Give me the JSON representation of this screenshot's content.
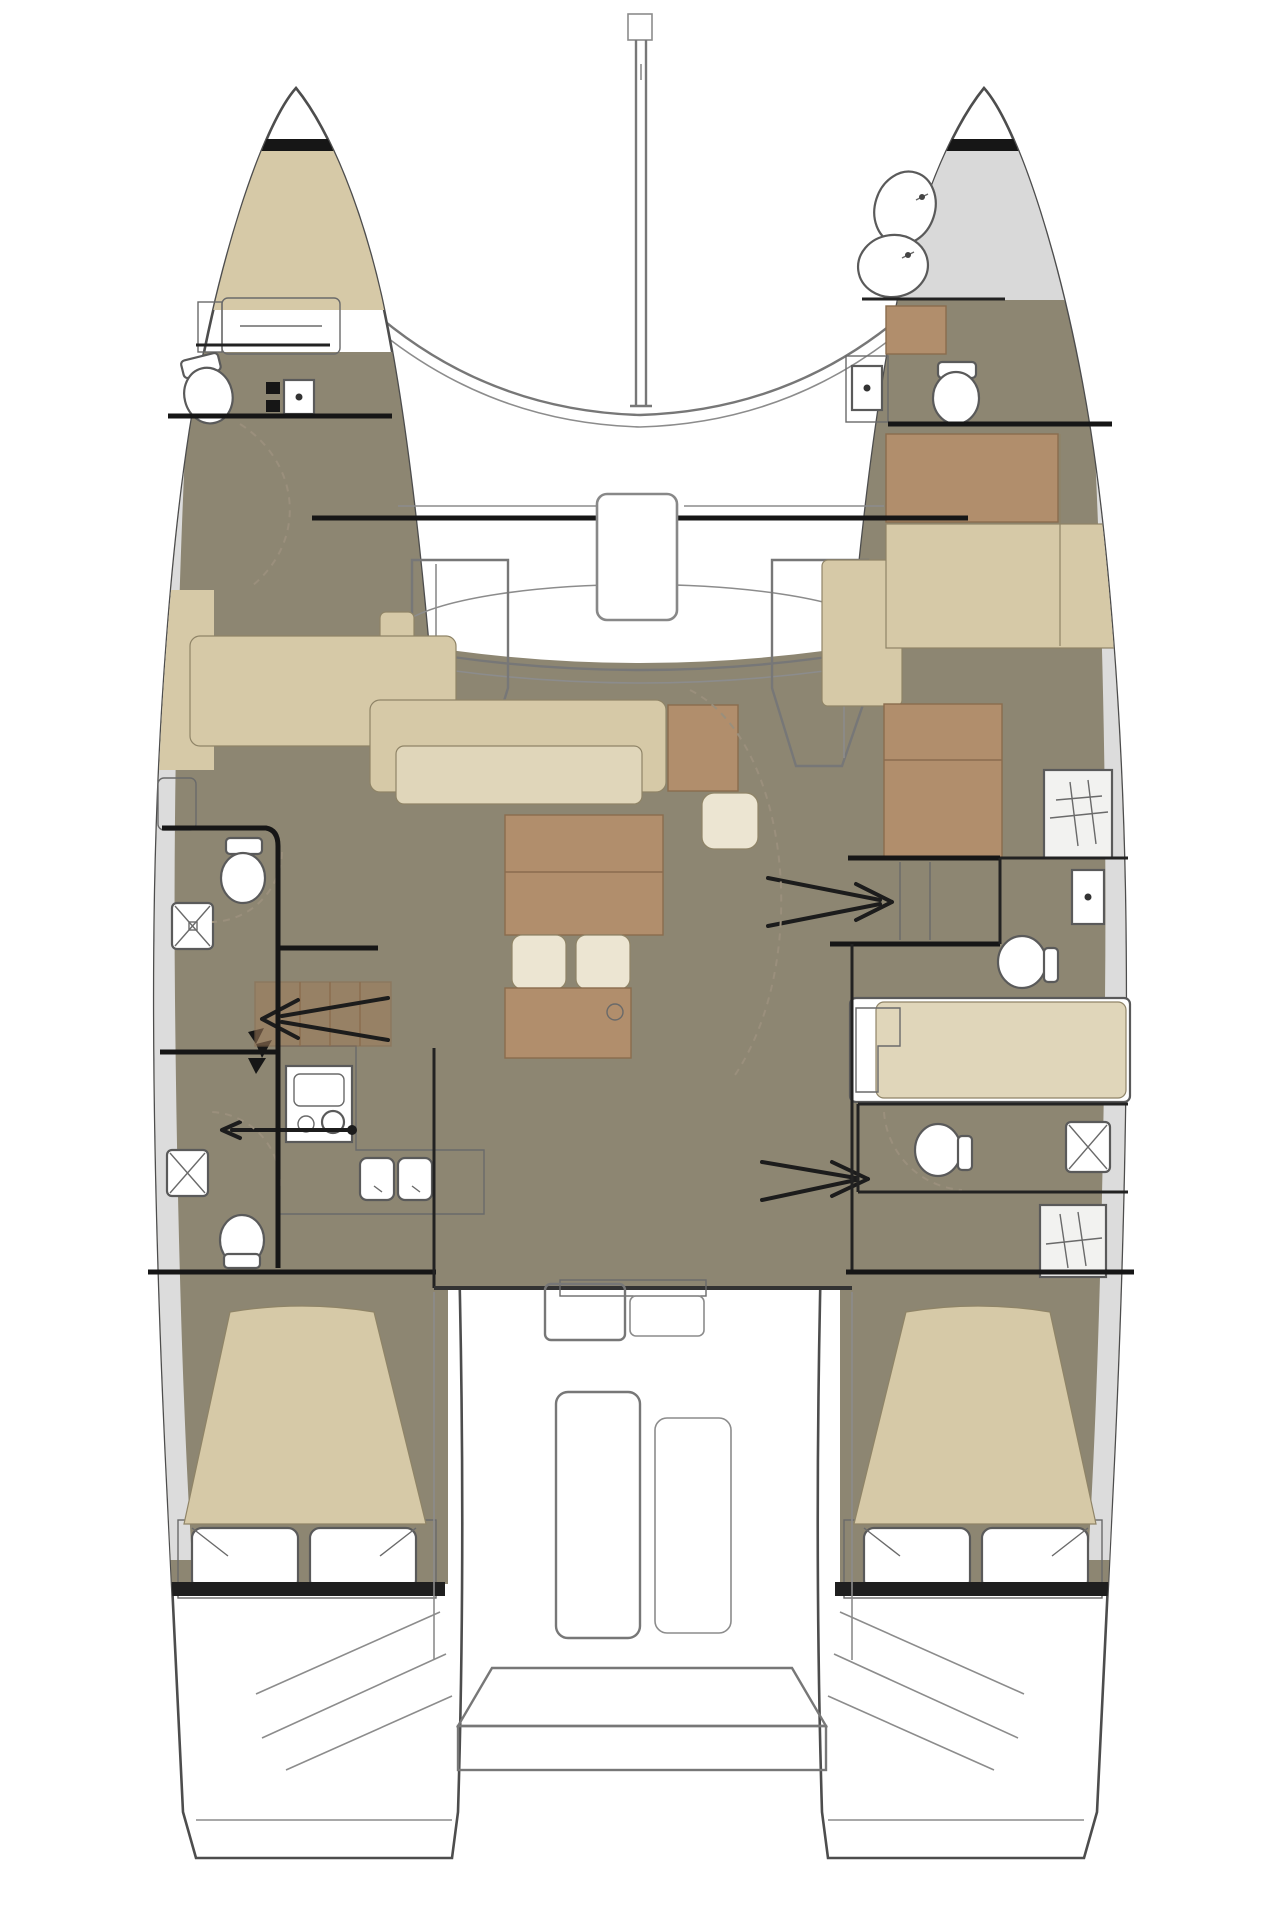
{
  "meta": {
    "title": "Catamaran interior deck plan, bow up, two hulls with salon and cockpit",
    "type": "floor-plan",
    "orientation": "bow-up"
  },
  "colors": {
    "background": "#ffffff",
    "hull_fill": "#ffffff",
    "hull_stroke": "#4d4d4d",
    "floor_olive": "#8d8672",
    "tan": "#d6c9a7",
    "tan_light": "#e0d6ba",
    "cream": "#ece5d2",
    "brown": "#b18e6c",
    "brown_dark": "#a07d5c",
    "counter_gray": "#c8c8c8",
    "deck_gray": "#dcdcdc",
    "forepeak_gray": "#d9d9d9",
    "fixture_white": "#ffffff",
    "wall_black": "#161616",
    "stern_band": "#1f1f1f",
    "line_gray": "#8c8c8c"
  },
  "vessel": {
    "hulls": [
      "port",
      "starboard"
    ],
    "areas": [
      "port-bow-locker",
      "port-forepeak-berth",
      "port-bow-head",
      "port-forward-cabin",
      "port-forward-head",
      "port-aft-head",
      "galley",
      "port-aft-cabin",
      "salon",
      "foredeck-trampoline",
      "mast",
      "cockpit",
      "aft-platform",
      "starboard-forepeak",
      "starboard-bow-head",
      "starboard-forward-cabin",
      "starboard-forward-head",
      "starboard-mid-berth",
      "starboard-aft-head",
      "starboard-aft-cabin"
    ],
    "fixtures": {
      "toilets": 6,
      "showers": 3,
      "sinks": 5,
      "stove_burners": 2,
      "double_beds": 4,
      "companionway_arrows": 3,
      "deck_hatches": 3
    }
  }
}
